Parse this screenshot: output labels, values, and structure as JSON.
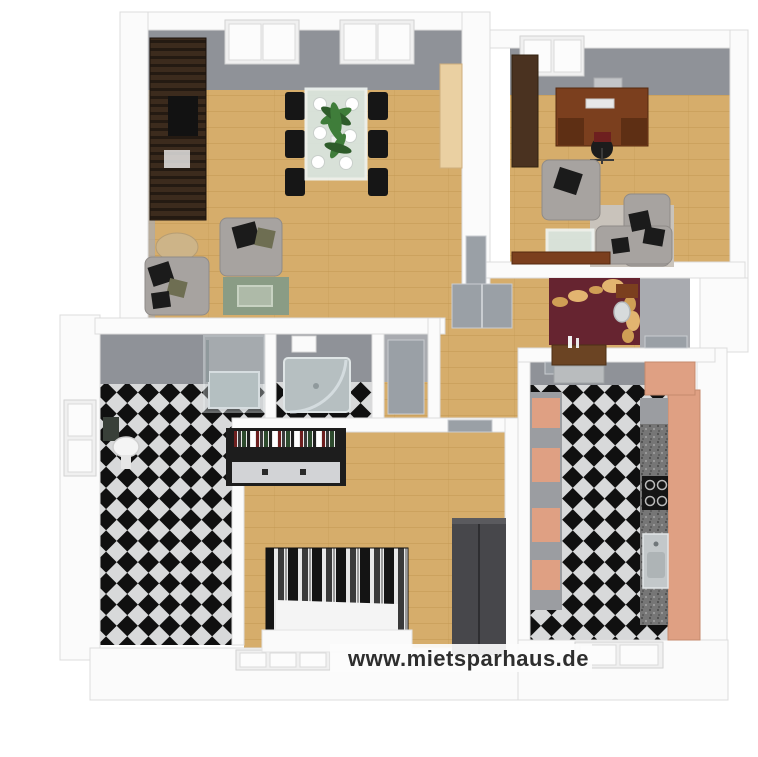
{
  "scene": {
    "kind": "3d-rendered-floor-plan",
    "view": "top-down isometric render of a furnished apartment"
  },
  "watermark": {
    "text": "www.mietsparhaus.de"
  },
  "colors": {
    "bg": "#ffffff",
    "wall_cap": "#fbfbfb",
    "wall_edge": "#dcdcdc",
    "wall_face": "#8f9298",
    "wall_face_light": "#a9abb0",
    "floor_wood": "#d6ad6b",
    "floor_wood_line": "#c1944e",
    "tile_dark": "#101010",
    "tile_light": "#d8d9da",
    "glass": "#d9e6e2",
    "glass_frame": "#eff4f2",
    "sofa_gray": "#a7a3a0",
    "pillow_black": "#1b1b1b",
    "pillow_olive": "#6e6e52",
    "rug_green": "#8a9c85",
    "table_beige": "#cdb488",
    "wenge_dark": "#241a12",
    "wenge_light": "#3c2b1d",
    "wood_brown": "#7b3f1e",
    "wood_brown_dark": "#5e2f14",
    "burgundy": "#662430",
    "gold": "#cf9e55",
    "salmon": "#dfa083",
    "granite": "#767676",
    "granite_dot": "#4f4f4f",
    "appliance_gray": "#9b9da1",
    "chrome": "#c7ced1",
    "white_fixture": "#f4f4f4",
    "wardrobe_gray": "#47474b",
    "dresser_black": "#1d1d1d",
    "drawer_light": "#d2d3d6",
    "bed_white": "#f4f4f4",
    "door_gray": "#9aa0a6",
    "plant_green": "#3f7d3a",
    "plant_dark": "#2e5c2a",
    "watermark_color": "#2e2e2e"
  },
  "rooms": [
    {
      "id": "living-dining-room",
      "floor": "wood",
      "furniture": [
        "media-wall-unit",
        "tv",
        "dining-table",
        "dining-chairs-x6",
        "plates-x6",
        "palm-plant",
        "armchair",
        "sofa",
        "round-side-table",
        "green-rug",
        "coffee-table",
        "tall-birch-cabinet"
      ]
    },
    {
      "id": "office",
      "floor": "wood",
      "furniture": [
        "desk",
        "monitor",
        "keyboard",
        "office-chair",
        "tall-wardrobe",
        "armchair",
        "corner-sofa",
        "rug",
        "glass-coffee-table",
        "sideboard"
      ]
    },
    {
      "id": "hallway",
      "floor": "wood",
      "accent_wall": "burgundy",
      "furniture": [
        "console-table",
        "vases",
        "wall-shelf",
        "wall-mirror",
        "gold-wall-decor"
      ]
    },
    {
      "id": "bathroom",
      "floor": "black-white-checker",
      "furniture": [
        "bathtub-with-shower-screen",
        "washbasin",
        "wall-cabinet"
      ]
    },
    {
      "id": "shower-room",
      "floor": "black-white-checker",
      "furniture": [
        "shower-tray",
        "glass-screen",
        "towel"
      ]
    },
    {
      "id": "bedroom",
      "floor": "wood",
      "furniture": [
        "double-bed-striped-duvet",
        "dresser-with-books",
        "wardrobe"
      ]
    },
    {
      "id": "kitchen",
      "floor": "black-white-checker",
      "furniture": [
        "kitchen-counter-granite",
        "cooktop",
        "sink",
        "salmon-cabinets",
        "tall-shelf-units",
        "extractor-unit"
      ]
    }
  ]
}
